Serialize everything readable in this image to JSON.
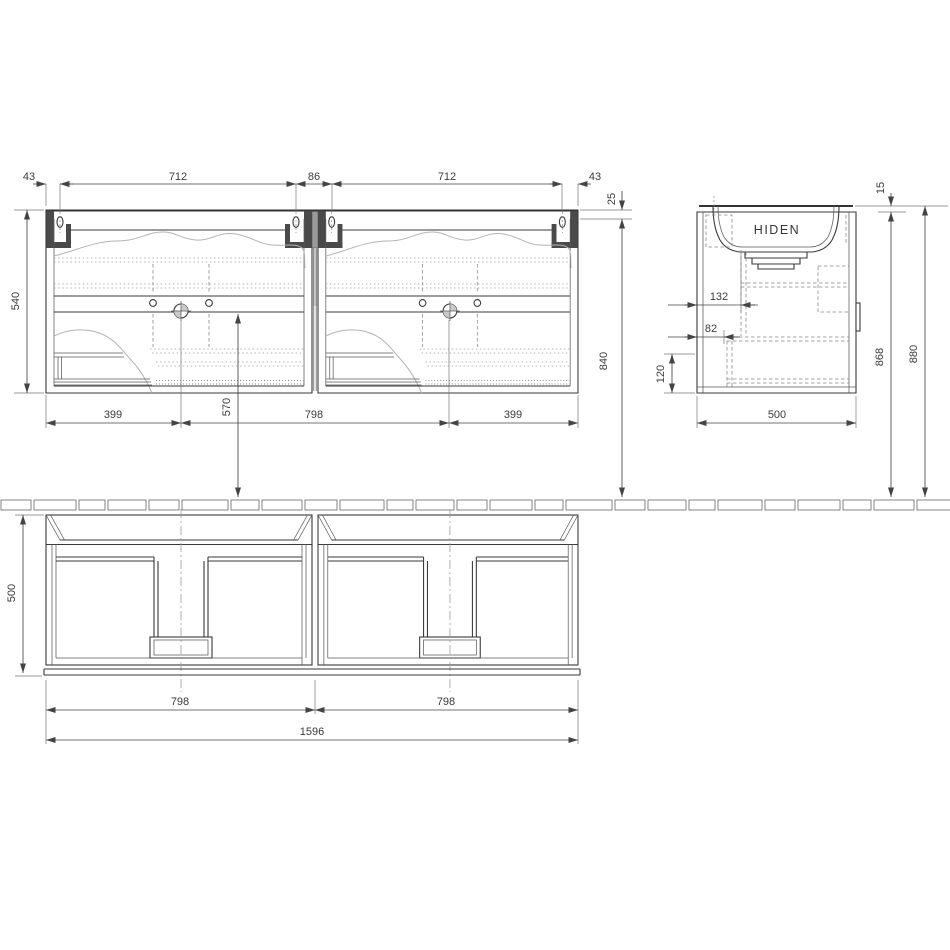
{
  "front_view": {
    "dims_top": [
      "43",
      "712",
      "86",
      "712",
      "43"
    ],
    "dim_counter_thickness": "25",
    "dim_height": "540",
    "dims_bottom": [
      "399",
      "798",
      "399"
    ],
    "dim_drain_to_floor": "570",
    "dim_top_to_floor": "840"
  },
  "side_view": {
    "basin_label": "HIDEN",
    "dim_rim_thickness": "15",
    "dim_offset_a": "132",
    "dim_offset_b": "82",
    "dim_drawer_front": "120",
    "dim_depth": "500",
    "dim_height_carcass": "868",
    "dim_height_overall": "880"
  },
  "plan_view": {
    "dim_depth": "500",
    "dims_halves": [
      "798",
      "798"
    ],
    "dim_overall_width": "1596"
  },
  "floor": {
    "plank_widths": [
      30,
      42,
      26,
      38,
      30,
      46,
      28,
      40,
      32,
      44,
      26,
      38,
      30,
      42,
      28,
      46,
      30,
      38,
      26,
      44,
      30,
      42,
      28,
      40,
      38
    ]
  }
}
